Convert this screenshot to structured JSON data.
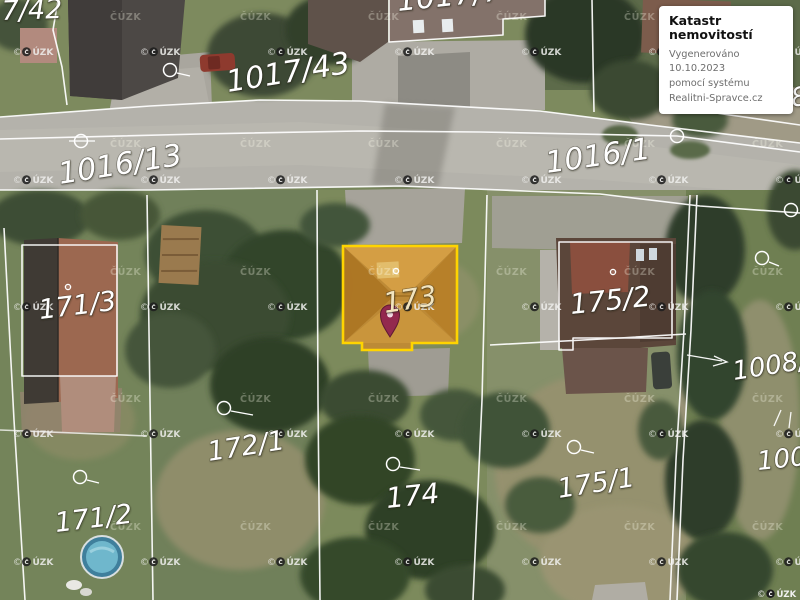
{
  "info_box": {
    "title": "Katastr nemovitostí",
    "line1": "Vygenerováno 10.10.2023",
    "line2": "pomocí systému",
    "line3": "Realitni-Spravce.cz"
  },
  "map": {
    "highlighted_parcel": {
      "number": "173",
      "border_color": "#ffd400",
      "fill_color": "#c08a34"
    },
    "parcel_labels": [
      {
        "text": "7/42",
        "x": 2,
        "y": 20,
        "size": 27,
        "rot": -2
      },
      {
        "text": "1017/43",
        "x": 228,
        "y": 92,
        "size": 30,
        "rot": -9
      },
      {
        "text": "1017/7",
        "x": 398,
        "y": 11,
        "size": 30,
        "rot": -6
      },
      {
        "text": "1016/13",
        "x": 60,
        "y": 184,
        "size": 30,
        "rot": -9
      },
      {
        "text": "1016/1",
        "x": 547,
        "y": 173,
        "size": 30,
        "rot": -8
      },
      {
        "text": "171/3",
        "x": 40,
        "y": 319,
        "size": 27,
        "rot": -7
      },
      {
        "text": "171/2",
        "x": 56,
        "y": 532,
        "size": 27,
        "rot": -7
      },
      {
        "text": "172/1",
        "x": 209,
        "y": 461,
        "size": 27,
        "rot": -9
      },
      {
        "text": "173",
        "x": 385,
        "y": 313,
        "size": 28,
        "rot": -9,
        "color": "#f2e4be"
      },
      {
        "text": "174",
        "x": 387,
        "y": 508,
        "size": 28,
        "rot": -6
      },
      {
        "text": "175/2",
        "x": 571,
        "y": 314,
        "size": 28,
        "rot": -6
      },
      {
        "text": "175/1",
        "x": 559,
        "y": 498,
        "size": 27,
        "rot": -9
      },
      {
        "text": "1008/2",
        "x": 734,
        "y": 380,
        "size": 26,
        "rot": -9
      },
      {
        "text": "1008",
        "x": 758,
        "y": 470,
        "size": 26,
        "rot": -6
      },
      {
        "text": "18",
        "x": 776,
        "y": 109,
        "size": 26,
        "rot": -8
      }
    ],
    "watermarks": {
      "logo_text": "ÚZK",
      "copyright_symbol": "©",
      "logo_grid": {
        "xs": [
          13,
          140,
          267,
          394,
          521,
          648,
          775
        ],
        "ys": [
          55,
          183,
          310,
          437,
          565
        ]
      },
      "faint_text": "ČÚZK",
      "faint_grid": {
        "xs": [
          110,
          240,
          368,
          496,
          624,
          752
        ],
        "ys": [
          20,
          147,
          275,
          402,
          530
        ]
      },
      "corner_attribution": "© ČÚZK"
    },
    "symbols": {
      "boundary_circles": [
        {
          "x": 81,
          "y": 141,
          "tail": [
            [
              69,
              141
            ],
            [
              95,
              141
            ]
          ]
        },
        {
          "x": 170,
          "y": 70,
          "tail": [
            [
              177,
              73
            ],
            [
              190,
              76
            ]
          ]
        },
        {
          "x": 677,
          "y": 136,
          "tail": null
        },
        {
          "x": 791,
          "y": 210,
          "tail": null
        },
        {
          "x": 224,
          "y": 408,
          "tail": [
            [
              231,
              411
            ],
            [
              253,
              415
            ]
          ]
        },
        {
          "x": 80,
          "y": 477,
          "tail": [
            [
              87,
              480
            ],
            [
              99,
              483
            ]
          ]
        },
        {
          "x": 393,
          "y": 464,
          "tail": [
            [
              400,
              467
            ],
            [
              420,
              470
            ]
          ]
        },
        {
          "x": 574,
          "y": 447,
          "tail": [
            [
              581,
              450
            ],
            [
              594,
              453
            ]
          ]
        },
        {
          "x": 762,
          "y": 258,
          "tail": [
            [
              769,
              262
            ],
            [
              779,
              266
            ]
          ]
        }
      ],
      "building_dots": [
        {
          "x": 68,
          "y": 287
        },
        {
          "x": 396,
          "y": 271
        },
        {
          "x": 613,
          "y": 272
        }
      ]
    }
  }
}
